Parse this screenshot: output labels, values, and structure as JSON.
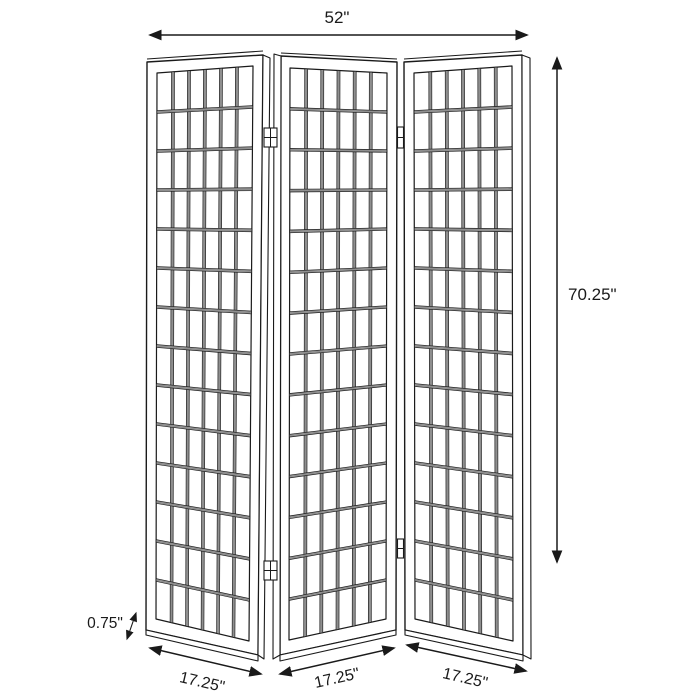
{
  "labels": {
    "total_width": "52\"",
    "height": "70.25\"",
    "frame_thickness": "0.75\"",
    "panel1_width": "17.25\"",
    "panel2_width": "17.25\"",
    "panel3_width": "17.25\""
  },
  "screen": {
    "panel_count": 3,
    "grid": {
      "columns": 6,
      "rows": 14
    }
  },
  "colors": {
    "line": "#1a1a1a",
    "mullion_fill": "#8f8f8f",
    "background": "#ffffff"
  }
}
